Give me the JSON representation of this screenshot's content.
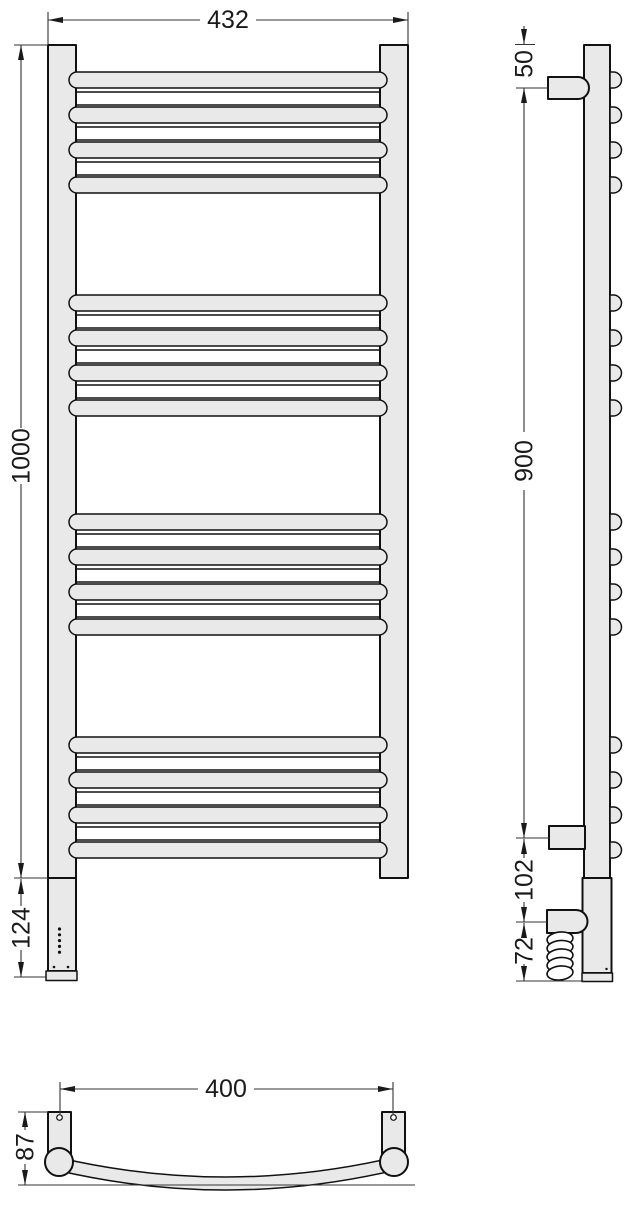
{
  "drawing_title": "Heated towel rail dimensional drawing",
  "views": {
    "front": {
      "dim_overall_width": "432",
      "dim_overall_height": "1000",
      "dim_heater_section": "124"
    },
    "side": {
      "dim_top_to_bracket": "50",
      "dim_bracket_span": "900",
      "dim_bracket_to_cable": "102",
      "dim_cable_to_bottom": "72"
    },
    "bottom": {
      "dim_mounting_width": "400",
      "dim_depth": "87"
    }
  },
  "rungs": {
    "group_tops": [
      72,
      295,
      514,
      737
    ],
    "bars_per_group": 4,
    "bar_pitch": 35,
    "bar_height": 16,
    "band_offset": 20,
    "band_height": 13
  },
  "indicator_dot_count": 5,
  "colors": {
    "part_fill": "#e9e9e9",
    "outline": "#111111",
    "dim_line": "#333333",
    "background": "#ffffff"
  }
}
